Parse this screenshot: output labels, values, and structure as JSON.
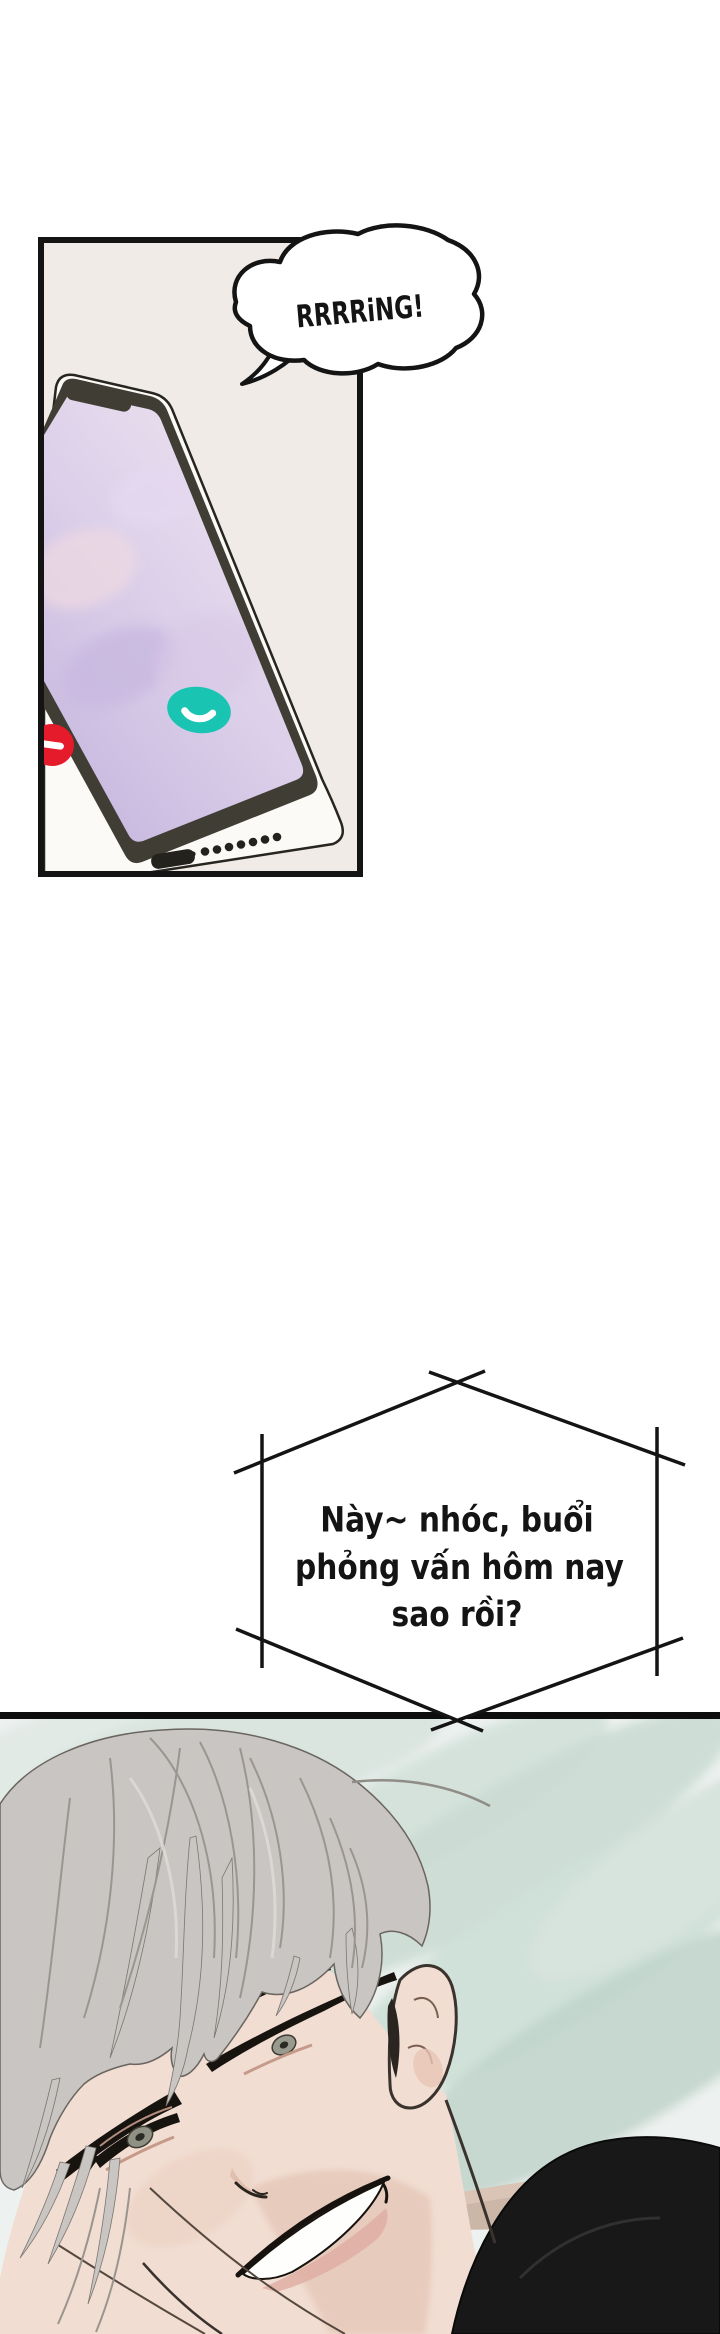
{
  "page": {
    "bg": "#ffffff"
  },
  "panel_phone": {
    "bg": "#f0ebe6",
    "border_color": "#141414",
    "sfx_bubble": {
      "text": "RRRRiNG!"
    },
    "phone": {
      "body_color": "#fbfaf7",
      "frame_color": "#403d34",
      "screen_top_color": "#efe5ef",
      "screen_bottom_color": "#c6b7de",
      "decline_button_color": "#e51a2b",
      "accept_button_color": "#19c4b3",
      "decline_icon": "phone-decline-icon",
      "accept_icon": "phone-accept-icon"
    }
  },
  "call_bubble": {
    "shape": "hexagon",
    "line1": "Này~ nhóc, buổi",
    "line2": "phỏng vấn hôm nay",
    "line3": "sao rồi?"
  },
  "panel_character": {
    "bg": "#edf1ef",
    "leaf_color": "#cfe0d8",
    "floor_color": "#ccb6a7",
    "shirt_color": "#181818",
    "hair_color": "#c8c5c2",
    "skin_color": "#f1ddd2"
  }
}
